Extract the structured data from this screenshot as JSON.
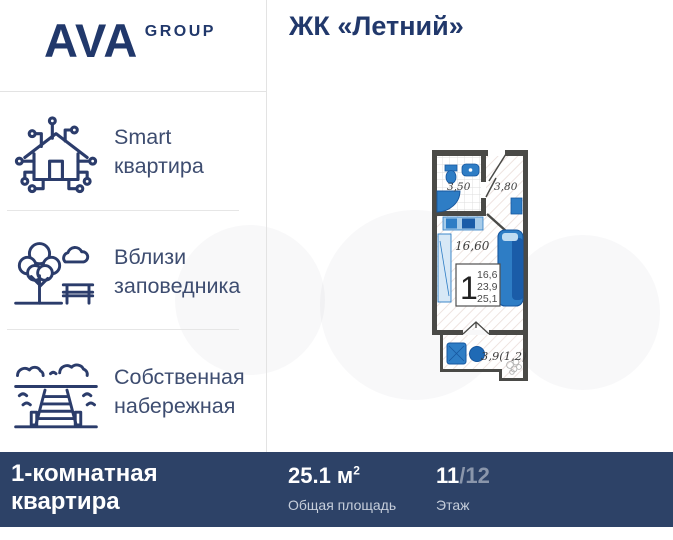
{
  "header": {
    "logo_main": "AVA",
    "logo_sub": "GROUP",
    "title": "ЖК «Летний»"
  },
  "features": [
    {
      "icon": "smart-home-icon",
      "lines": [
        "Smart",
        "квартира"
      ]
    },
    {
      "icon": "park-icon",
      "lines": [
        "Вблизи",
        "заповедника"
      ]
    },
    {
      "icon": "waterfront-icon",
      "lines": [
        "Собственная",
        "набережная"
      ]
    }
  ],
  "floorplan": {
    "room_labels": {
      "bathroom_area": "3,50",
      "hallway_area": "3,80",
      "living_area": "16,60",
      "balcony_area": "3,9(1,2)"
    },
    "info_box": {
      "rooms": "1",
      "areas": [
        "16,6",
        "23,9",
        "25,1"
      ]
    }
  },
  "footer": {
    "apartment_type_line1": "1-комнатная",
    "apartment_type_line2": "квартира",
    "area_value": "25.1 м",
    "area_superscript": "2",
    "area_label": "Общая площадь",
    "floor_current": "11",
    "floor_separator": "/",
    "floor_total": "12",
    "floor_label": "Этаж"
  },
  "colors": {
    "brand_navy": "#21386b",
    "footer_bg": "#2d4267",
    "accent_blue": "#2e7dc5",
    "floor_total_muted": "#8a96ab"
  }
}
